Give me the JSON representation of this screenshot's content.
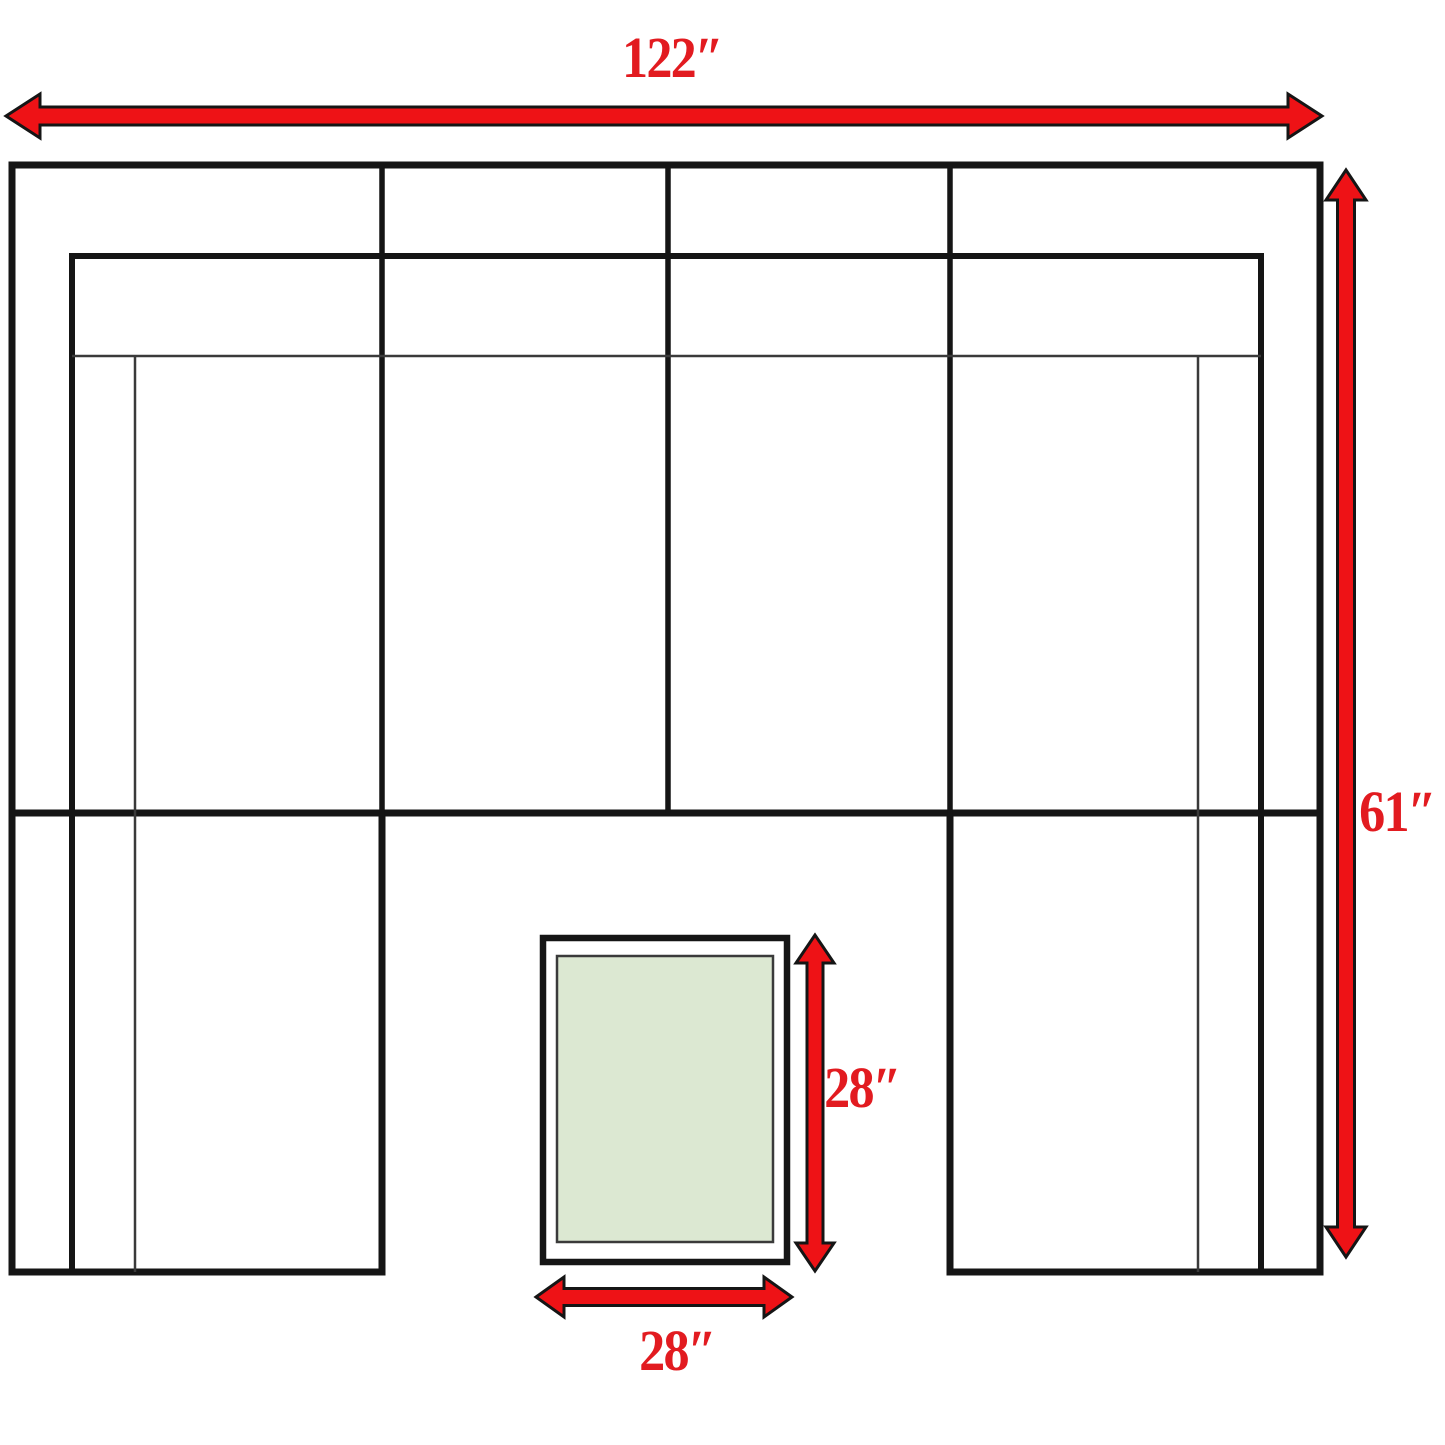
{
  "colors": {
    "bg": "#ffffff",
    "arrow-red": "#ee1216",
    "label-red": "#e21b20",
    "line-black": "#151515",
    "line-thin": "#3a3a3a",
    "ottoman-green": "#dce8d2",
    "ottoman-border": "#3a3a3a"
  },
  "dimensions": {
    "overall_width": "122″",
    "overall_depth": "61″",
    "ottoman_depth": "28″",
    "ottoman_width": "28″"
  }
}
